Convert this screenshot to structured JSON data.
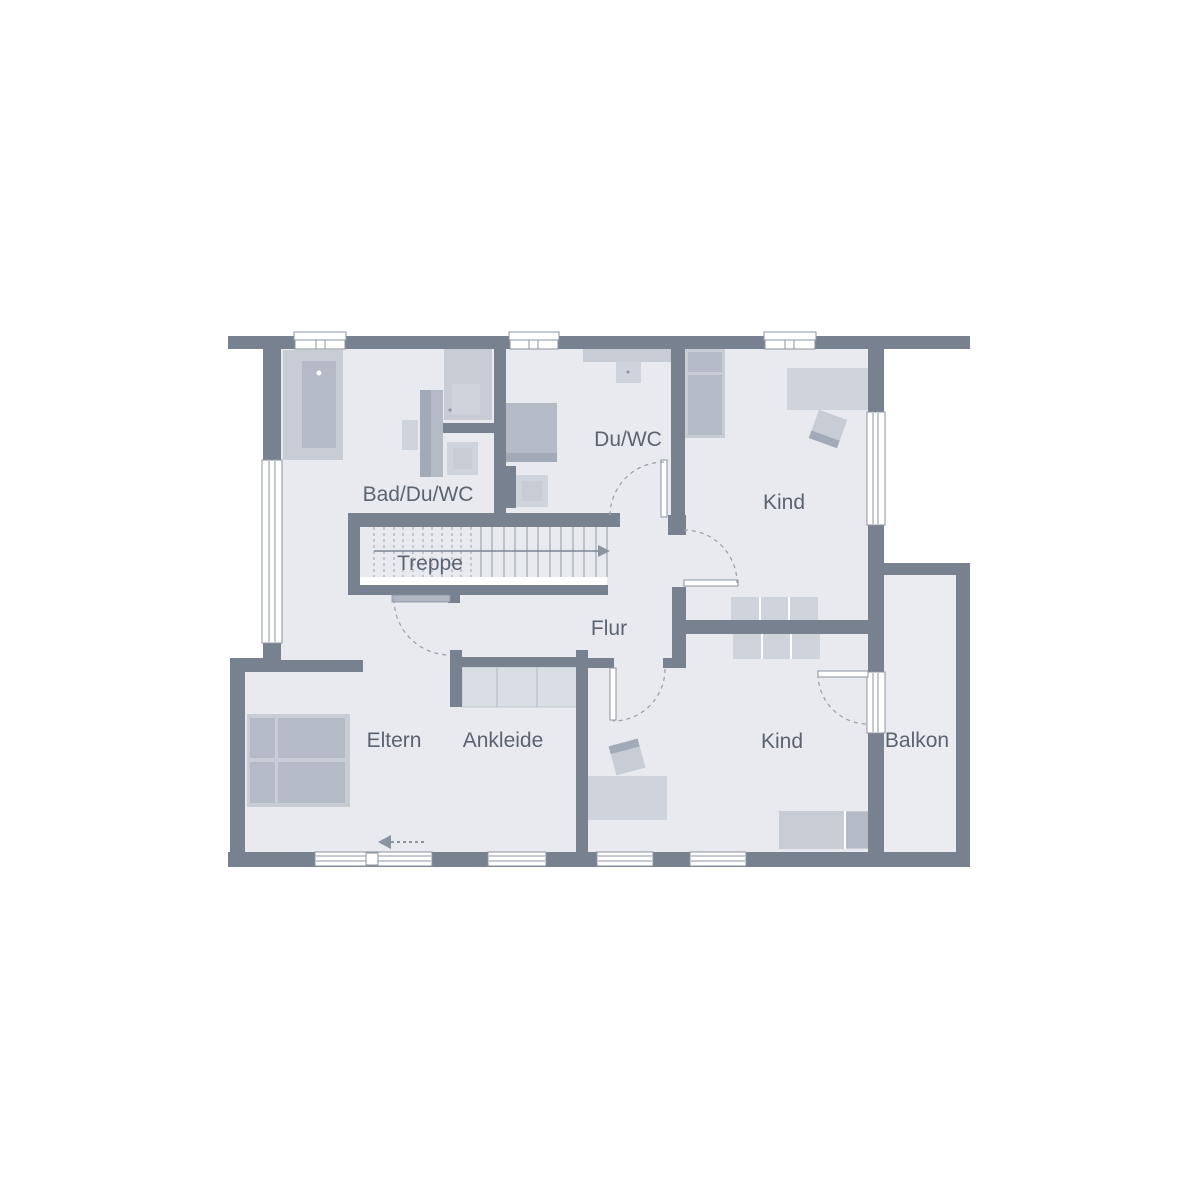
{
  "plan": {
    "type": "floor-plan",
    "language": "de",
    "rooms": [
      {
        "id": "bad-du-wc",
        "label": "Bad/Du/WC"
      },
      {
        "id": "du-wc",
        "label": "Du/WC"
      },
      {
        "id": "treppe",
        "label": "Treppe"
      },
      {
        "id": "flur",
        "label": "Flur"
      },
      {
        "id": "kind-top",
        "label": "Kind"
      },
      {
        "id": "eltern",
        "label": "Eltern"
      },
      {
        "id": "ankleide",
        "label": "Ankleide"
      },
      {
        "id": "kind-bottom",
        "label": "Kind"
      },
      {
        "id": "balkon",
        "label": "Balkon"
      }
    ]
  },
  "palette": {
    "wall": "#78818f",
    "floor": "#e8eaef",
    "floor_balcony": "#eaecf1",
    "furn_light": "#cfd3db",
    "furn_mid": "#c7ccd5",
    "furn_dark": "#b4bac6",
    "furn_darker": "#a3aab7",
    "accent": "#8b93a0",
    "line": "#8b93a0",
    "line_light": "#9ba3b0",
    "closet": "#d9dde4",
    "text": "#5c6370"
  }
}
